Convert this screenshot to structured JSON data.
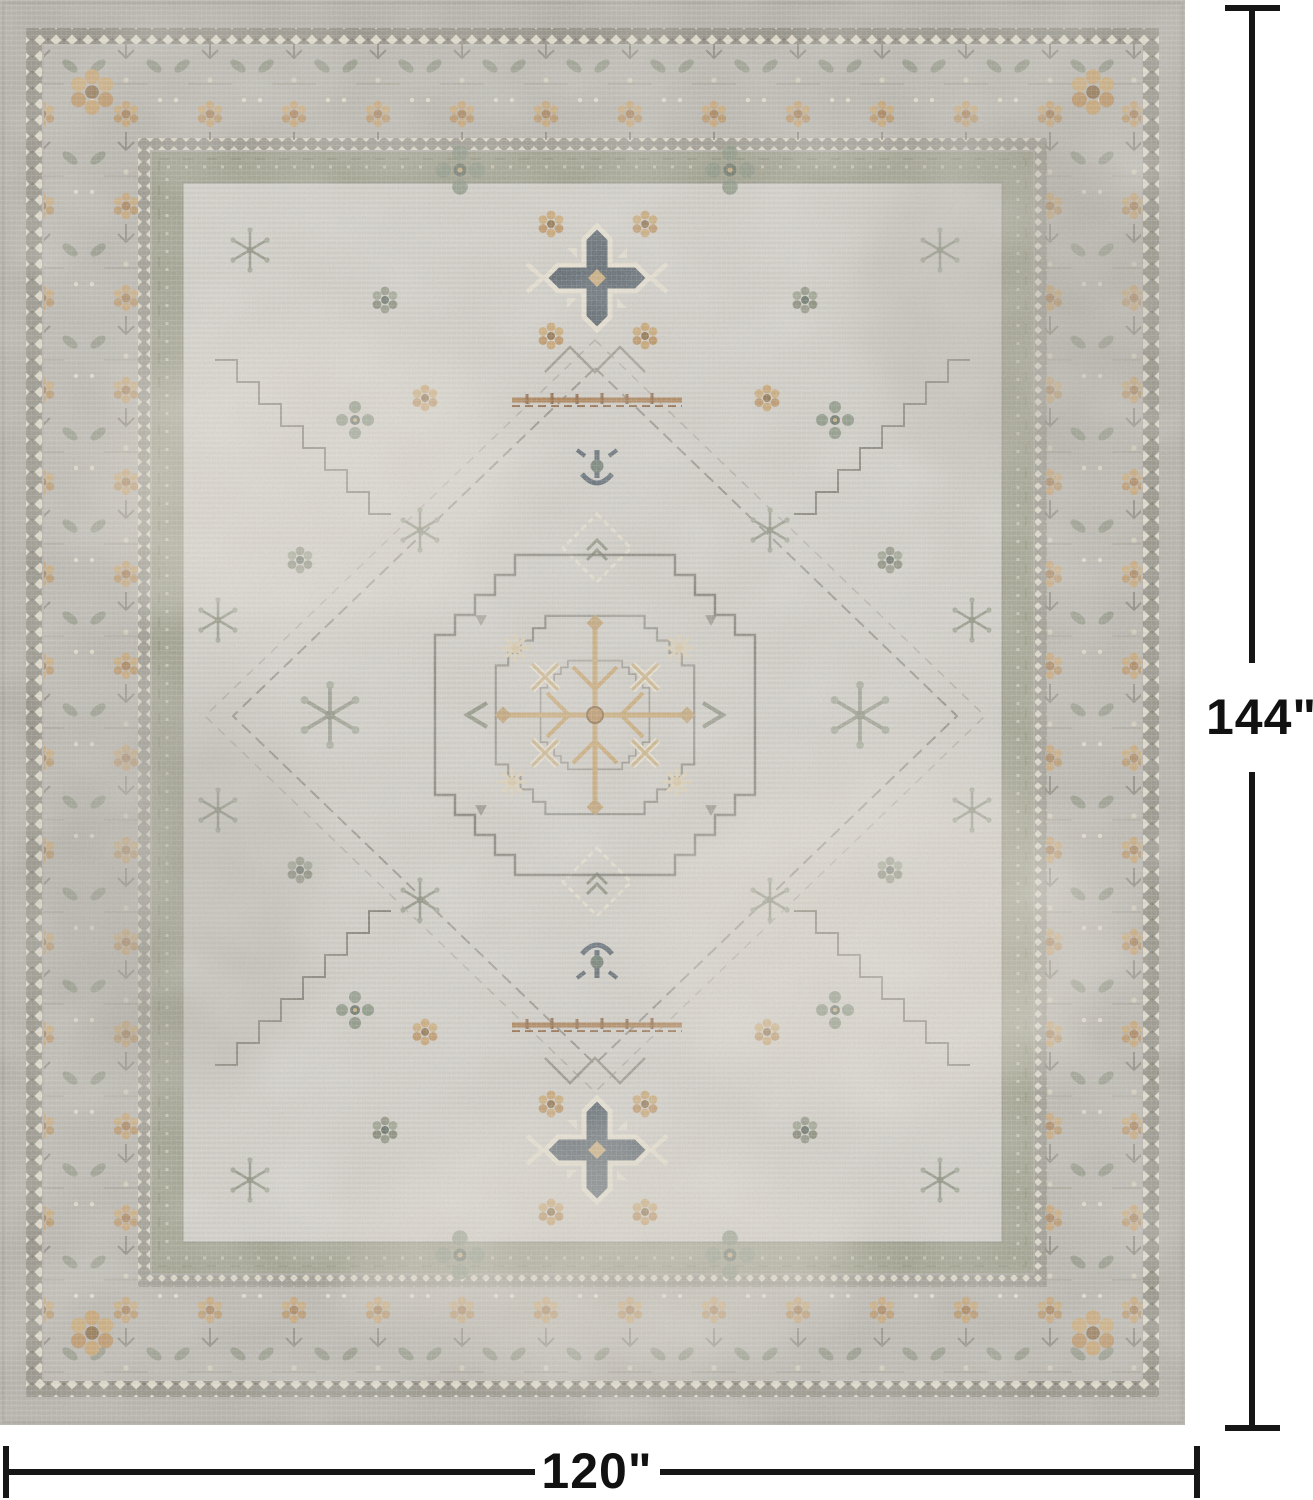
{
  "page": {
    "background": "#ffffff"
  },
  "product_image": {
    "subject": "distressed vintage oriental-style area rug, top view",
    "field_color": "#d1cec7",
    "border_color": "#b7b4ac",
    "accent_colors": [
      "#c7a06a",
      "#8d9180",
      "#4f5b64",
      "#e9e2d1",
      "#a67848",
      "#9a9b86"
    ]
  },
  "dimensions": {
    "height_label": "144\"",
    "width_label": "120\""
  }
}
